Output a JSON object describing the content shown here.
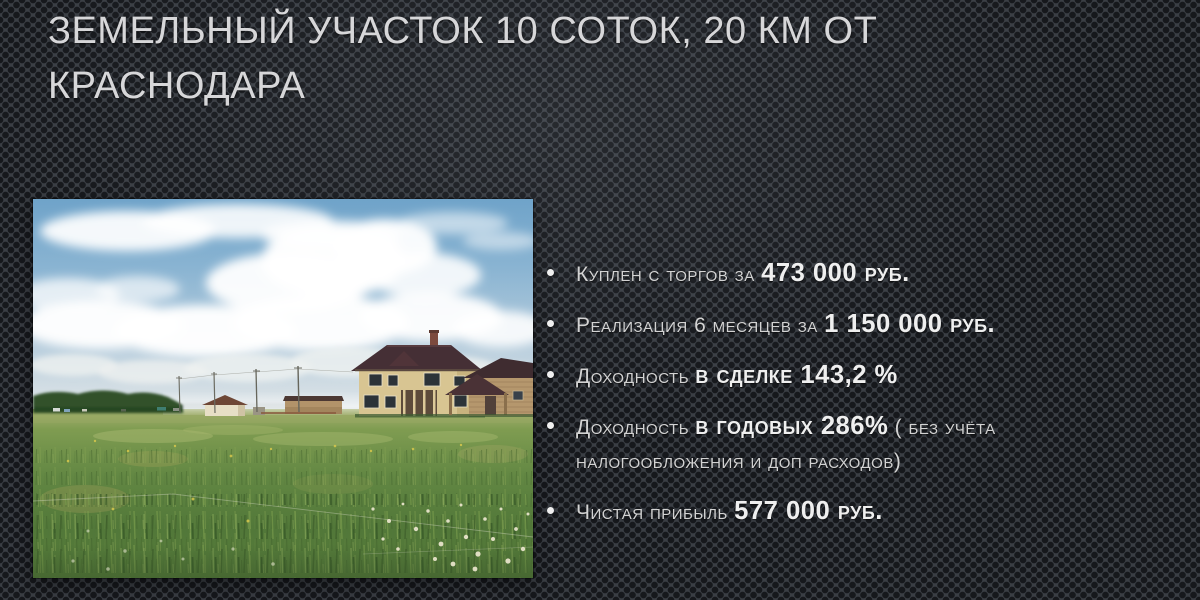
{
  "slide": {
    "title": "Земельный участок 10 соток, 20 км от Краснодара",
    "photo_description": "Загородный дом и деревянные постройки на зелёном поле под облачным небом",
    "bullets": [
      {
        "segments": [
          {
            "t": "Куплен с торгов за ",
            "b": false
          },
          {
            "t": "473 000 руб.",
            "b": true
          }
        ]
      },
      {
        "segments": [
          {
            "t": "Реализация 6 месяцев за ",
            "b": false
          },
          {
            "t": "1 150 000 руб.",
            "b": true
          }
        ]
      },
      {
        "segments": [
          {
            "t": "Доходность ",
            "b": false
          },
          {
            "t": "в сделке 143,2 %",
            "b": true
          }
        ]
      },
      {
        "segments": [
          {
            "t": "Доходность ",
            "b": false
          },
          {
            "t": "в годовых 286%",
            "b": true
          },
          {
            "t": " ( без учёта налогообложения и доп расходов)",
            "b": false
          }
        ]
      },
      {
        "segments": [
          {
            "t": "Чистая прибыль ",
            "b": false
          },
          {
            "t": "577 000 руб.",
            "b": true
          }
        ]
      }
    ]
  },
  "colors": {
    "background_base": "#3a3e44",
    "background_dot": "#16181c",
    "title_text": "#d7d7d9",
    "body_text": "#d3d3d3",
    "bold_text": "#efefef",
    "bullet_marker": "#f0f0f0"
  }
}
